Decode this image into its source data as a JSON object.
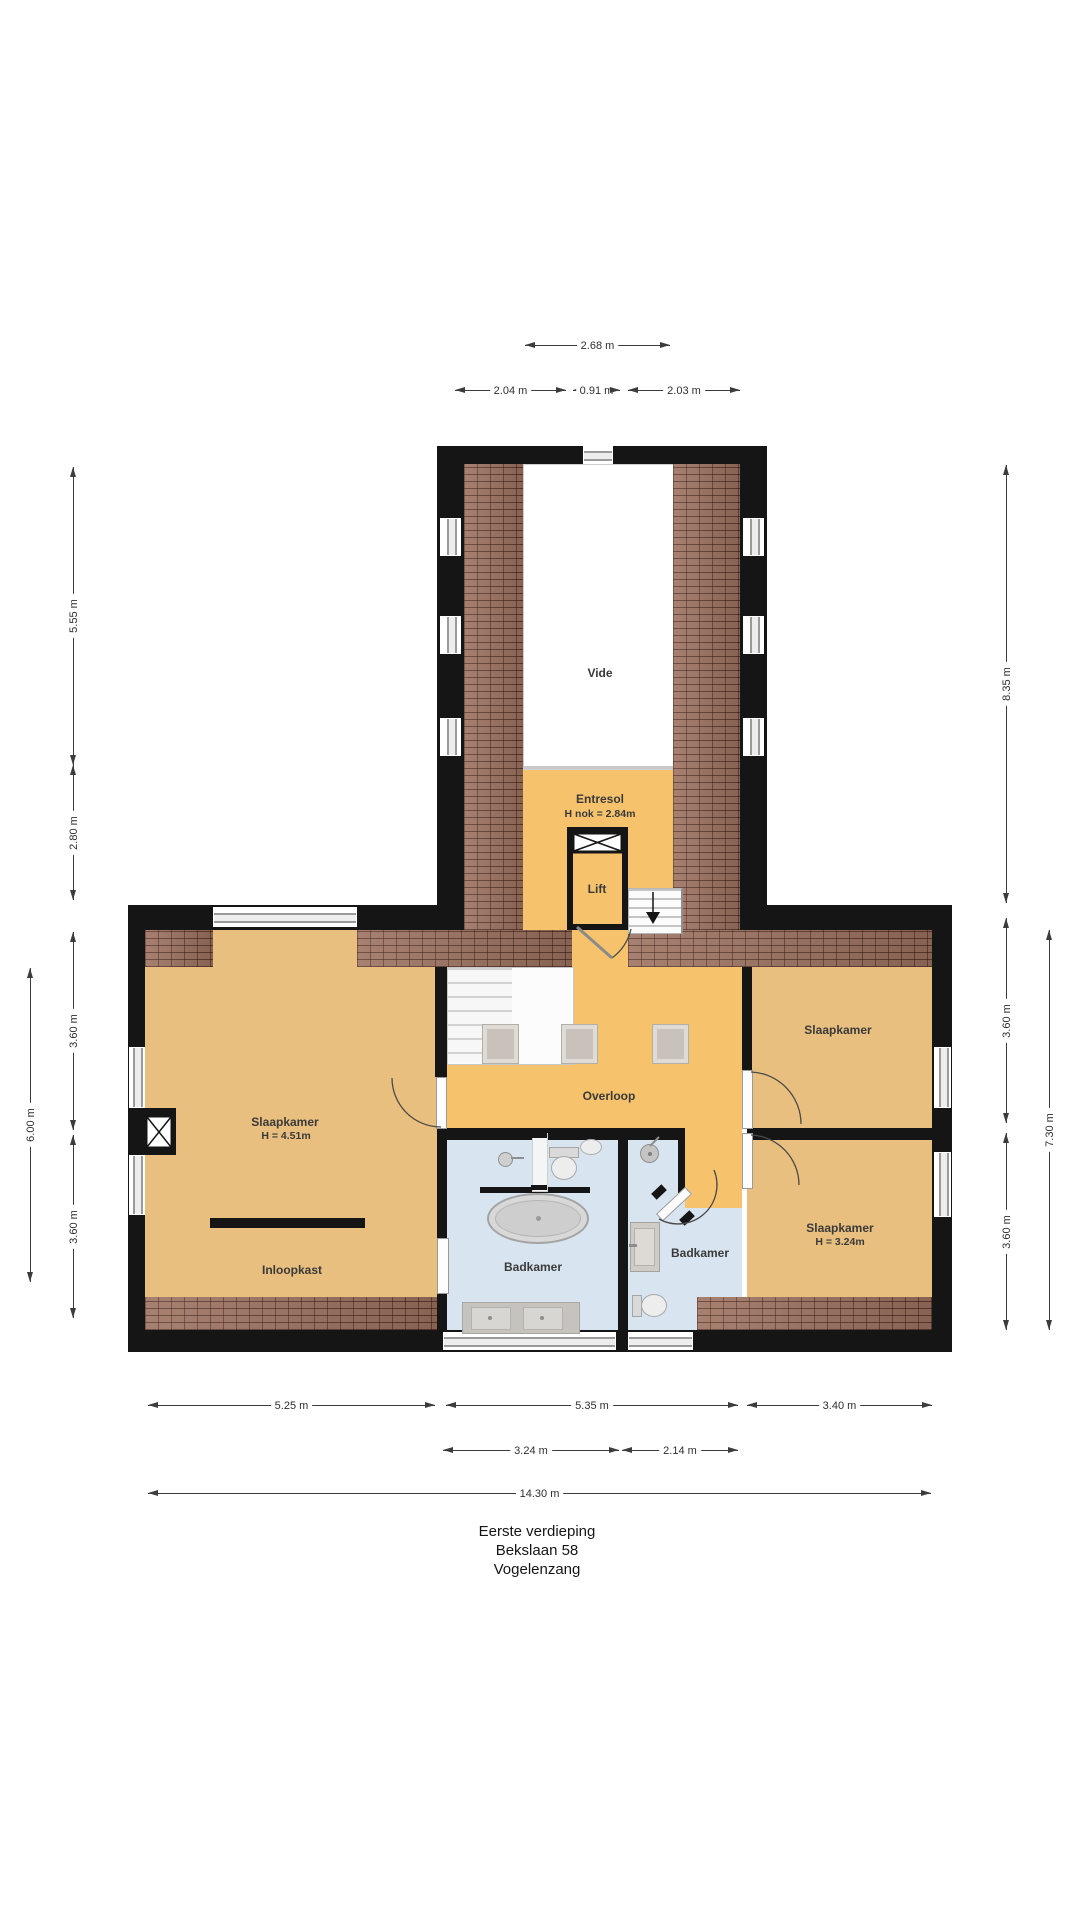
{
  "meta": {
    "floor": "Eerste verdieping",
    "address": "Bekslaan 58",
    "city": "Vogelenzang"
  },
  "rooms": {
    "vide": "Vide",
    "entresol": "Entresol",
    "entresol_height": "H nok = 2.84m",
    "lift": "Lift",
    "overloop": "Overloop",
    "slaapkamer_left": "Slaapkamer",
    "slaapkamer_left_height": "H = 4.51m",
    "inloopkast": "Inloopkast",
    "badkamer_main": "Badkamer",
    "badkamer_small": "Badkamer",
    "slaapkamer_top_right": "Slaapkamer",
    "slaapkamer_bottom_right": "Slaapkamer",
    "slaapkamer_bottom_right_height": "H = 3.24m"
  },
  "dimensions": {
    "top": [
      "2.68 m",
      "2.04 m",
      "0.91 m",
      "2.03 m"
    ],
    "left": [
      "5.55 m",
      "2.80 m",
      "3.60 m",
      "3.60 m",
      "6.00 m"
    ],
    "right": [
      "8.35 m",
      "3.60 m",
      "3.60 m",
      "7.30 m"
    ],
    "bottom": [
      "5.25 m",
      "5.35 m",
      "3.40 m",
      "3.24 m",
      "2.14 m",
      "14.30 m"
    ]
  },
  "colors": {
    "wall": "#151515",
    "floor_circulation": "#F6C36C",
    "floor_bedroom": "#E8BF7E",
    "floor_bathroom": "#D8E4EF",
    "roof_tiles": "#9D7260",
    "window_frame": "#9A9A9A",
    "text": "#3A3A3A"
  }
}
